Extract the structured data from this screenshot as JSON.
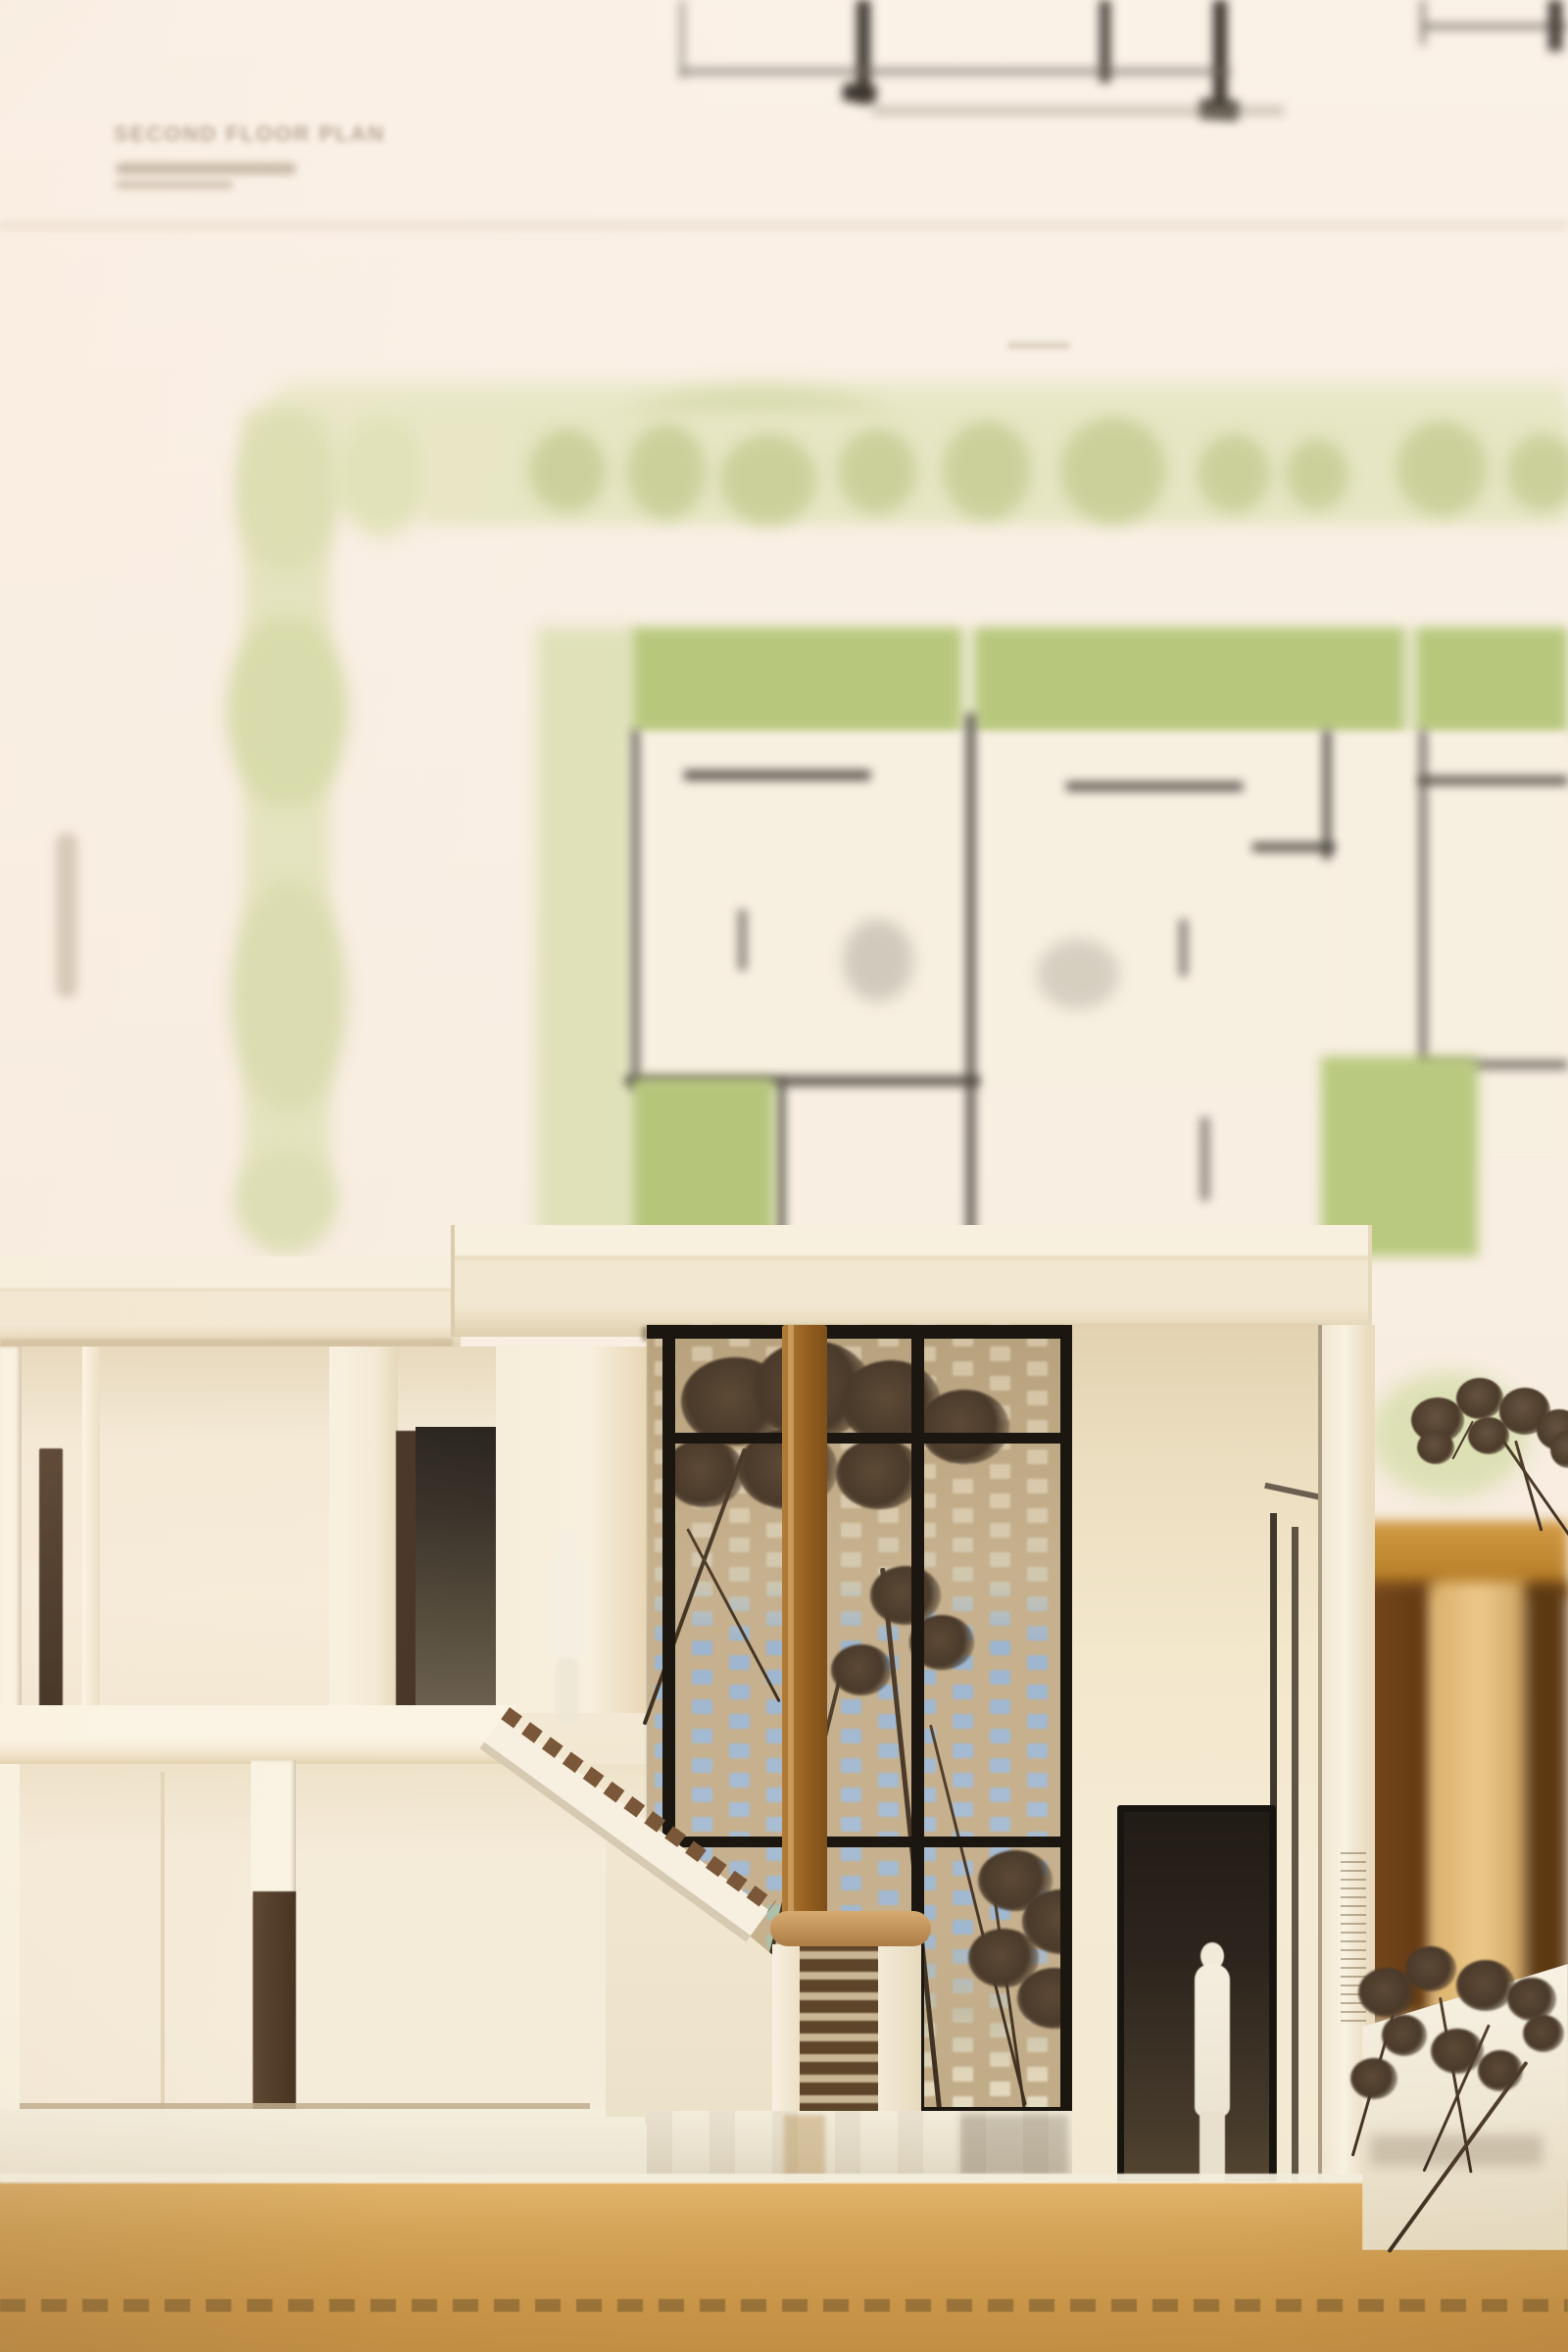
{
  "poster": {
    "title": "SECOND FLOOR PLAN"
  },
  "palette": {
    "poster_cream": "#f8efe4",
    "poster_green_pale": "#e7e6c4",
    "poster_green_tree": "#d8dcab",
    "poster_green_garden": "#b7c87d",
    "plan_line_dark": "#45403a",
    "model_white": "#f8f1e1",
    "model_cream": "#f1e6cf",
    "roof_shadow": "#d8c7a5",
    "frame_dark_wood": "#483526",
    "lattice_tan": "#c6b08d",
    "sky_blue": "#9db5cf",
    "stair_tread": "#7a5738",
    "handrail_wood": "#c39a62",
    "column_wood": "#9c6c2e",
    "door_dark": "#26201a",
    "figure_white": "#f2ecdf",
    "plant_dark": "#4e3d2b",
    "furniture_amber": "#bd8732",
    "furniture_dark": "#6b401a",
    "cardboard_base": "#cf9f55",
    "base_stitch": "#8c6a34"
  }
}
